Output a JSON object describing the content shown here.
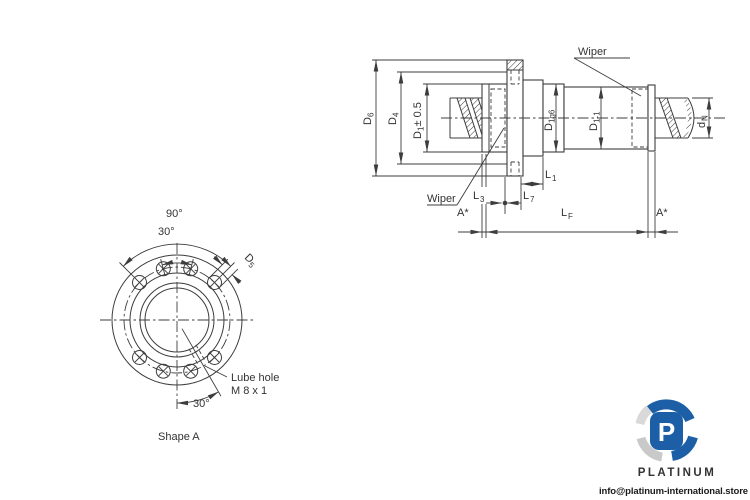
{
  "drawing": {
    "side_view": {
      "wiper_top": "Wiper",
      "wiper_left": "Wiper",
      "dim_d6": {
        "base": "D",
        "sub": "6"
      },
      "dim_d4": {
        "base": "D",
        "sub": "4"
      },
      "dim_d1": {
        "base": "D",
        "sub": "1",
        "tol": " ± 0.5"
      },
      "dim_d1g6": {
        "base": "D",
        "sub": "1g6"
      },
      "dim_dl1": {
        "base": "D",
        "sub": "1-1"
      },
      "dim_dn": {
        "base": "d",
        "sub": "N"
      },
      "dim_l1": {
        "base": "L",
        "sub": "1"
      },
      "dim_l3": {
        "base": "L",
        "sub": "3"
      },
      "dim_l7": {
        "base": "L",
        "sub": "7"
      },
      "dim_lf": {
        "base": "L",
        "sub": "F"
      },
      "dim_a_left": "A*",
      "dim_a_right": "A*"
    },
    "front_view": {
      "caption": "Shape A",
      "angle_90": "90°",
      "angle_30_top": "30°",
      "angle_30_bottom": "30°",
      "dim_d5": {
        "base": "D",
        "sub": "5"
      },
      "lube_hole_line1": "Lube hole",
      "lube_hole_line2": "M 8 x 1"
    }
  },
  "watermark": {
    "logo_letter": "P",
    "brand": "PLATINUM",
    "email": "info@platinum-international.store",
    "brand_color": "#1d5fa7",
    "swirl_gray": "#c9c9c9",
    "swirl_gray_light": "#d9d9d9"
  },
  "style": {
    "line_color": "#3d3d3d"
  }
}
